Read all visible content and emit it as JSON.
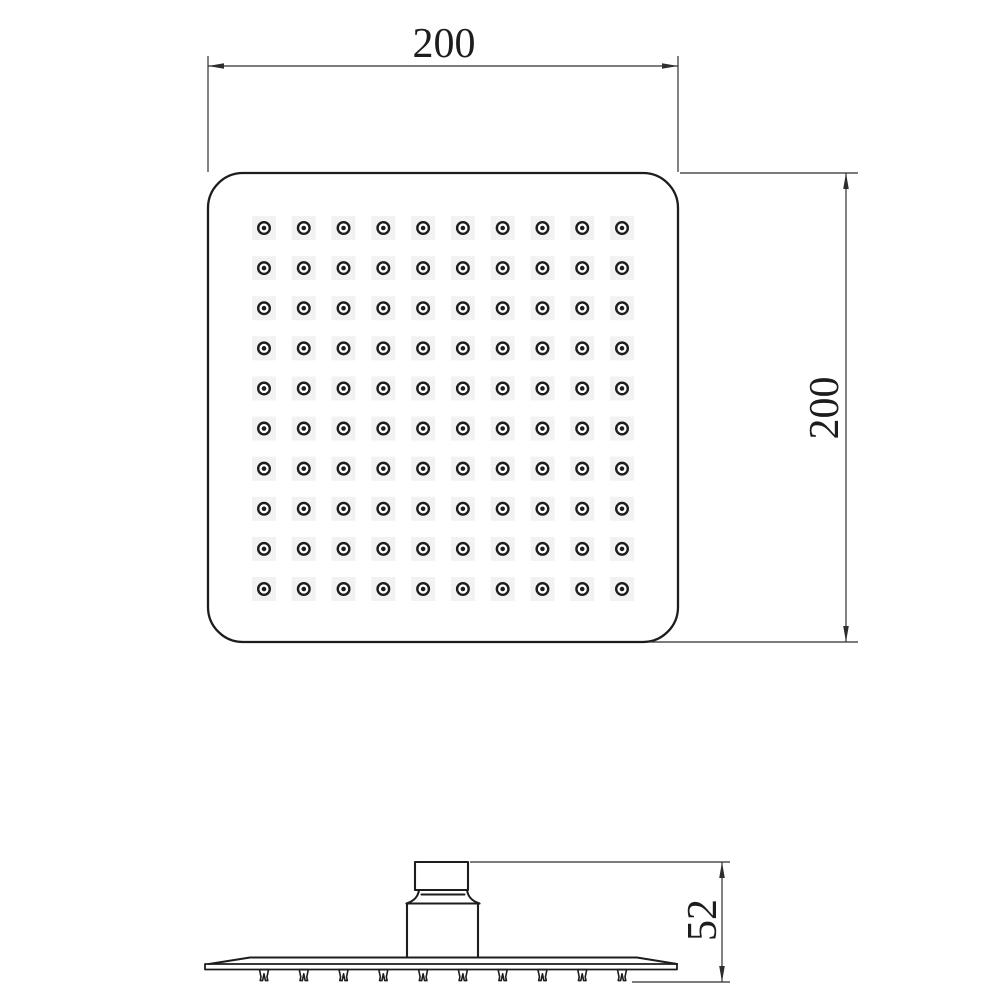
{
  "page": {
    "background": "#ffffff",
    "line_color": "#1d1d1d",
    "dim_line_color": "#2e2e2e",
    "hole_halo_color": "#f2f2f2",
    "description": "Technical dimension drawing of a square rain shower head, top view and side view"
  },
  "views": {
    "top_view": {
      "name": "top-view",
      "shape": "rounded-square",
      "grid": {
        "rows": 10,
        "cols": 10,
        "hole_count": 100
      },
      "width_dim": "200",
      "height_dim": "200"
    },
    "side_view": {
      "name": "side-view",
      "nozzle_count": 10,
      "height_dim": "52",
      "parts": [
        "inlet-connector",
        "swivel-collar",
        "body-block",
        "spray-plate",
        "nozzle-tips"
      ]
    }
  },
  "dimensions": [
    {
      "id": "top-width",
      "value": "200",
      "orientation": "horizontal"
    },
    {
      "id": "right-height",
      "value": "200",
      "orientation": "vertical"
    },
    {
      "id": "side-height",
      "value": "52",
      "orientation": "vertical"
    }
  ]
}
